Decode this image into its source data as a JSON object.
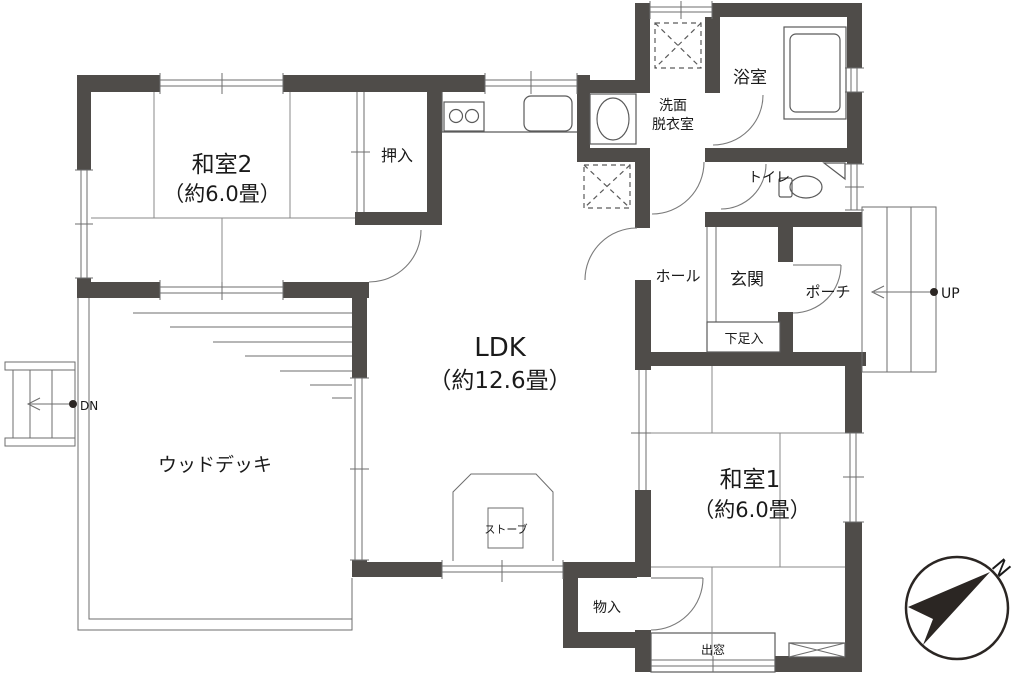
{
  "floorplan": {
    "rooms": {
      "washitsu2": {
        "name": "和室2",
        "size": "（約6.0畳）"
      },
      "washitsu1": {
        "name": "和室1",
        "size": "（約6.0畳）"
      },
      "ldk": {
        "name": "LDK",
        "size": "（約12.6畳）"
      },
      "oshiire": {
        "label": "押入"
      },
      "senmen": {
        "line1": "洗面",
        "line2": "脱衣室"
      },
      "bathroom": {
        "label": "浴室"
      },
      "toilet": {
        "label": "トイレ"
      },
      "hall": {
        "label": "ホール"
      },
      "genkan": {
        "label": "玄関"
      },
      "porch": {
        "label": "ポーチ"
      },
      "getabako": {
        "label": "下足入"
      },
      "mononyu": {
        "label": "物入"
      },
      "wood_deck": {
        "label": "ウッドデッキ"
      },
      "stove": {
        "label": "ストーブ"
      },
      "bay_window": {
        "label": "出窓"
      }
    },
    "markers": {
      "up": "UP",
      "down": "DN",
      "north": "N"
    },
    "colors": {
      "wall": "#4f4c49",
      "line": "#5a5a5a",
      "text": "#1a1a1a"
    }
  }
}
